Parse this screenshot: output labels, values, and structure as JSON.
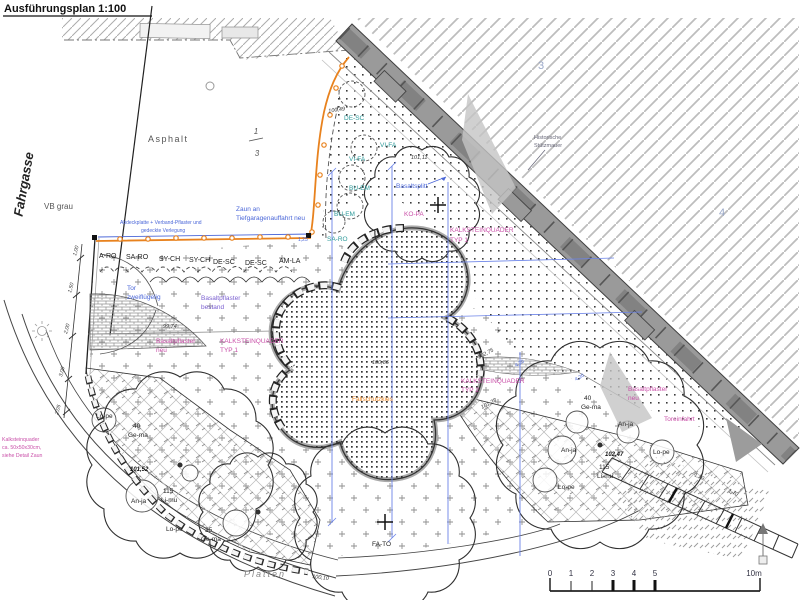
{
  "drawing": {
    "title": "Ausführungsplan 1:100",
    "street": "Fahrgasse",
    "parcels": {
      "p1_top": "1",
      "p1_bottom": "3",
      "p3": "3",
      "p4": "4"
    },
    "surfaces": {
      "asphalt": "Asphalt",
      "vb_grau": "VB grau",
      "platten": "Platten",
      "basaltsplitt": "Basaltsplitt",
      "fallschutz": "Fallschutzkies",
      "basalt_bestand": [
        "Basaltpflaster",
        "bestand"
      ],
      "basalt_neu_w": [
        "Basaltpflaster",
        "neu"
      ],
      "basalt_neu_o": [
        "Basaltpflaster",
        "neu"
      ]
    },
    "structures": {
      "zaun": [
        "Zaun an",
        "Tiefgaragenauffahrt neu"
      ],
      "zaun_detail": [
        "Abdeckplatte + Verband-Pflaster und",
        "gedeckte Verlegung"
      ],
      "tor": [
        "Tor",
        "zweiflügelig"
      ],
      "toreinfahrt": "Toreinfahrt",
      "mauer": [
        "Historische",
        "Stützmauer"
      ],
      "kalk_typ1_w": [
        "KALKSTEINQUADER",
        "TYP 1"
      ],
      "kalk_typ1_o": [
        "KALKSTEINQUADER",
        "TYP 1"
      ],
      "kalk_typ2": [
        "KALKSTEINQUADER",
        "TYP 2"
      ],
      "kalk_note": [
        "Kalksteinquader",
        "ca. 50x50x30cm,",
        "siehe Detail Zaun"
      ]
    },
    "plants": {
      "row": [
        "A-RO",
        "SA-RO",
        "SY-CH",
        "SY-CH",
        "DE-SC",
        "DE-SC",
        "AM-LA"
      ],
      "fence": [
        "DE-SC",
        "VI-FA",
        "VI-FA",
        "BU-EM",
        "BU-EM",
        "SA-RO"
      ],
      "trees": {
        "ko_pa": "KO-PA",
        "fa_to": "FA-TO"
      },
      "bed_w": [
        {
          "count": "",
          "code": "Lo-pe"
        },
        {
          "count": "40",
          "code": "Ge-ma"
        },
        {
          "count": "",
          "code": "An-ja"
        },
        {
          "count": "115",
          "code": "Li-mu"
        },
        {
          "count": "",
          "code": "Lo-pe"
        },
        {
          "count": "35",
          "code": "Ge-ma"
        }
      ],
      "bed_o": [
        {
          "count": "40",
          "code": "Ge-ma"
        },
        {
          "count": "",
          "code": "An-ja"
        },
        {
          "count": "",
          "code": "An-ja"
        },
        {
          "count": "",
          "code": "Lo-pe"
        },
        {
          "count": "115",
          "code": "Li-mu"
        },
        {
          "count": "",
          "code": "Lo-pe"
        }
      ]
    },
    "elevations": {
      "e1": "100,49",
      "e2": "101,11",
      "e3": "100,86",
      "e4": "99,74",
      "e5": "101,28",
      "e6": "102,75",
      "e7": "100,10",
      "e8": "102,47",
      "e9": "101,52"
    },
    "dimensions": {
      "left": [
        "1,00",
        "1,50",
        "2,00",
        "3,00",
        "2,05"
      ],
      "blue": [
        "4,20",
        "4,20",
        "1,25"
      ],
      "steps": [
        "1,70",
        "1,70"
      ]
    },
    "scalebar": {
      "ticks": [
        "0",
        "1",
        "2",
        "3",
        "4",
        "5"
      ],
      "end": "10m"
    },
    "colors": {
      "fence_orange": "#E8821E",
      "annotation_blue": "#4A66D8",
      "label_pink": "#C94FA8",
      "label_violet": "#7A5FD0",
      "label_teal": "#2E9A9A",
      "wall_gray": "#9A9A9A"
    }
  }
}
